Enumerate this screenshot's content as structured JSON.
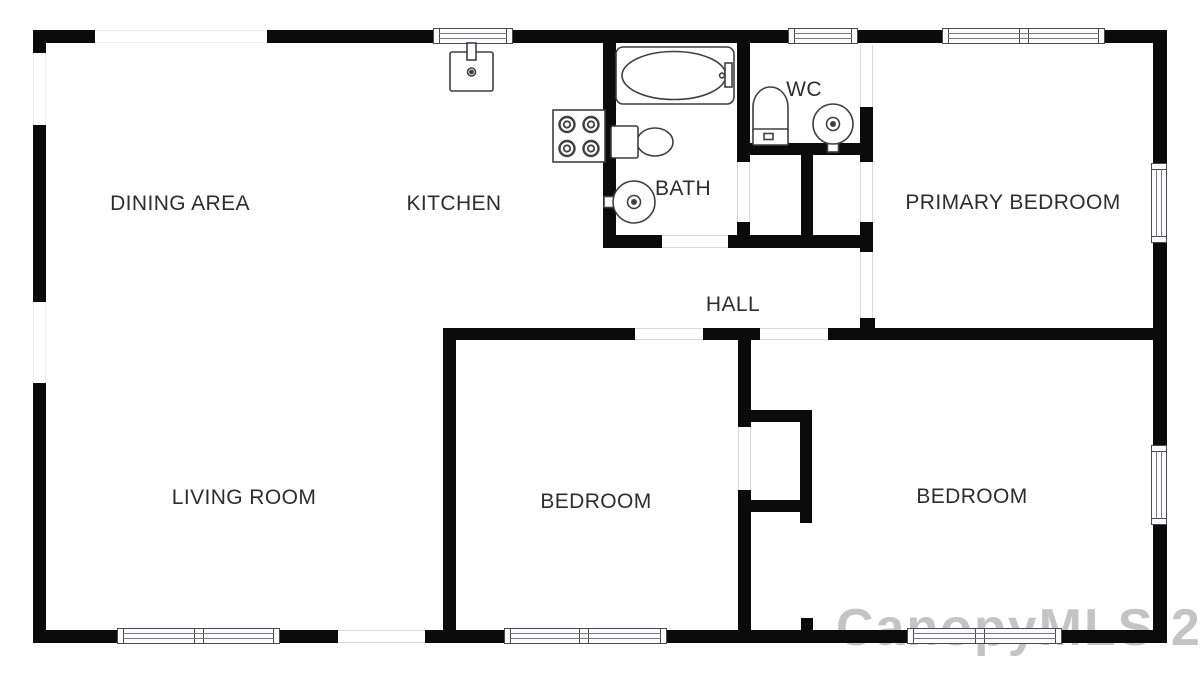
{
  "colors": {
    "wall": "#0b0b0b",
    "window_frame": "#4a4a4a",
    "fixture_stroke": "#3f3f3f",
    "label_text": "#2d2d2d",
    "background": "#ffffff"
  },
  "rooms": [
    {
      "label": "DINING AREA",
      "x": 180,
      "y": 204
    },
    {
      "label": "KITCHEN",
      "x": 454,
      "y": 204
    },
    {
      "label": "BATH",
      "x": 683,
      "y": 189
    },
    {
      "label": "WC",
      "x": 804,
      "y": 90
    },
    {
      "label": "PRIMARY BEDROOM",
      "x": 1013,
      "y": 203
    },
    {
      "label": "HALL",
      "x": 733,
      "y": 305
    },
    {
      "label": "LIVING ROOM",
      "x": 244,
      "y": 498
    },
    {
      "label": "BEDROOM",
      "x": 596,
      "y": 502
    },
    {
      "label": "BEDROOM",
      "x": 972,
      "y": 497
    }
  ],
  "watermark": {
    "text": "CanopyMLS 2023"
  },
  "floorplan": {
    "width": 1200,
    "height": 674,
    "walls": [
      {
        "name": "exterior-wall-top",
        "x": 33,
        "y": 30,
        "w": 1134,
        "h": 13
      },
      {
        "name": "exterior-wall-bottom",
        "x": 33,
        "y": 630,
        "w": 1134,
        "h": 13
      },
      {
        "name": "exterior-wall-left",
        "x": 33,
        "y": 30,
        "w": 13,
        "h": 613
      },
      {
        "name": "exterior-wall-right",
        "x": 1153,
        "y": 30,
        "w": 14,
        "h": 613
      },
      {
        "name": "bath-west-wall",
        "x": 603,
        "y": 43,
        "w": 13,
        "h": 197
      },
      {
        "name": "bath-south-wall",
        "x": 603,
        "y": 235,
        "w": 59,
        "h": 13
      },
      {
        "name": "closet-south-wall",
        "x": 728,
        "y": 235,
        "w": 145,
        "h": 13
      },
      {
        "name": "bath-wc-divider-wall",
        "x": 737,
        "y": 43,
        "w": 13,
        "h": 119
      },
      {
        "name": "wc-south-wall",
        "x": 737,
        "y": 143,
        "w": 136,
        "h": 12
      },
      {
        "name": "closet-divider-wall",
        "x": 801,
        "y": 155,
        "w": 12,
        "h": 93
      },
      {
        "name": "hall-closet-west-jamb",
        "x": 737,
        "y": 222,
        "w": 13,
        "h": 26
      },
      {
        "name": "primary-west-wall-upper",
        "x": 860,
        "y": 107,
        "w": 13,
        "h": 55
      },
      {
        "name": "primary-west-wall-mid",
        "x": 860,
        "y": 222,
        "w": 13,
        "h": 30
      },
      {
        "name": "primary-west-wall-stub",
        "x": 860,
        "y": 318,
        "w": 15,
        "h": 11
      },
      {
        "name": "hall-south-wall-left",
        "x": 443,
        "y": 328,
        "w": 192,
        "h": 12
      },
      {
        "name": "hall-south-wall-mid",
        "x": 703,
        "y": 328,
        "w": 57,
        "h": 12
      },
      {
        "name": "bedrooms-divider-north-wall",
        "x": 828,
        "y": 328,
        "w": 325,
        "h": 12
      },
      {
        "name": "middle-bedroom-west-wall",
        "x": 443,
        "y": 328,
        "w": 13,
        "h": 315
      },
      {
        "name": "bedroom-divider-wall-upper",
        "x": 738,
        "y": 328,
        "w": 13,
        "h": 99
      },
      {
        "name": "bedroom-divider-wall-lower",
        "x": 738,
        "y": 490,
        "w": 13,
        "h": 153
      },
      {
        "name": "bedroom-closet-north-wall",
        "x": 738,
        "y": 410,
        "w": 74,
        "h": 12
      },
      {
        "name": "bedroom-closet-east-wall",
        "x": 800,
        "y": 410,
        "w": 12,
        "h": 113
      },
      {
        "name": "bedroom-closet-south-wall",
        "x": 738,
        "y": 500,
        "w": 74,
        "h": 12
      },
      {
        "name": "bottom-wall-jamb-stub",
        "x": 801,
        "y": 618,
        "w": 12,
        "h": 13
      }
    ],
    "openings": [
      {
        "name": "dining-window-opening",
        "style": "plain",
        "orient": "h",
        "x": 95,
        "y": 30,
        "w": 172,
        "h": 13,
        "mullions": []
      },
      {
        "name": "kitchen-window",
        "style": "framed",
        "orient": "h",
        "x": 433,
        "y": 28,
        "w": 80,
        "h": 16,
        "mullions": []
      },
      {
        "name": "wc-window",
        "style": "framed",
        "orient": "h",
        "x": 788,
        "y": 28,
        "w": 70,
        "h": 16,
        "mullions": []
      },
      {
        "name": "primary-bedroom-north-window",
        "style": "framed",
        "orient": "h",
        "x": 942,
        "y": 28,
        "w": 163,
        "h": 16,
        "mullions": [
          0.5
        ]
      },
      {
        "name": "dining-side-window-opening",
        "style": "plain",
        "orient": "v",
        "x": 33,
        "y": 53,
        "w": 13,
        "h": 72,
        "mullions": []
      },
      {
        "name": "living-side-window-opening",
        "style": "plain",
        "orient": "v",
        "x": 33,
        "y": 302,
        "w": 13,
        "h": 81,
        "mullions": []
      },
      {
        "name": "primary-bedroom-east-window",
        "style": "framed",
        "orient": "v",
        "x": 1151,
        "y": 163,
        "w": 16,
        "h": 80,
        "mullions": []
      },
      {
        "name": "right-bedroom-east-window",
        "style": "framed",
        "orient": "v",
        "x": 1151,
        "y": 445,
        "w": 16,
        "h": 80,
        "mullions": []
      },
      {
        "name": "living-room-window",
        "style": "framed",
        "orient": "h",
        "x": 117,
        "y": 628,
        "w": 163,
        "h": 16,
        "mullions": [
          0.5
        ]
      },
      {
        "name": "living-room-entry-opening",
        "style": "door",
        "orient": "h",
        "x": 338,
        "y": 630,
        "w": 87,
        "h": 13,
        "mullions": []
      },
      {
        "name": "middle-bedroom-window",
        "style": "framed",
        "orient": "h",
        "x": 504,
        "y": 628,
        "w": 163,
        "h": 16,
        "mullions": [
          0.49
        ]
      },
      {
        "name": "right-bedroom-window",
        "style": "framed",
        "orient": "h",
        "x": 907,
        "y": 628,
        "w": 155,
        "h": 16,
        "mullions": [
          0.47
        ]
      },
      {
        "name": "bath-door-opening",
        "style": "door",
        "orient": "h",
        "x": 662,
        "y": 235,
        "w": 66,
        "h": 13,
        "mullions": []
      },
      {
        "name": "hall-closet-door-opening",
        "style": "door",
        "orient": "v",
        "x": 737,
        "y": 162,
        "w": 13,
        "h": 60,
        "mullions": []
      },
      {
        "name": "primary-closet-door-opening",
        "style": "door",
        "orient": "v",
        "x": 860,
        "y": 162,
        "w": 13,
        "h": 60,
        "mullions": []
      },
      {
        "name": "wc-entry-opening",
        "style": "door",
        "orient": "v",
        "x": 860,
        "y": 45,
        "w": 13,
        "h": 62,
        "mullions": []
      },
      {
        "name": "primary-bedroom-door-opening",
        "style": "door",
        "orient": "v",
        "x": 860,
        "y": 252,
        "w": 13,
        "h": 66,
        "mullions": []
      },
      {
        "name": "middle-bedroom-door-opening",
        "style": "door",
        "orient": "h",
        "x": 635,
        "y": 328,
        "w": 68,
        "h": 12,
        "mullions": []
      },
      {
        "name": "right-bedroom-door-opening",
        "style": "door",
        "orient": "h",
        "x": 760,
        "y": 328,
        "w": 68,
        "h": 12,
        "mullions": []
      },
      {
        "name": "bedroom-closet-door-opening",
        "style": "door",
        "orient": "v",
        "x": 738,
        "y": 427,
        "w": 13,
        "h": 63,
        "mullions": []
      }
    ],
    "fixtures": [
      {
        "name": "kitchen-sink",
        "type": "sink-square",
        "x": 450,
        "y": 52,
        "w": 43,
        "h": 39
      },
      {
        "name": "stove",
        "type": "stove",
        "x": 553,
        "y": 110,
        "w": 52,
        "h": 52
      },
      {
        "name": "bathtub",
        "type": "tub",
        "x": 616,
        "y": 47,
        "w": 118,
        "h": 57
      },
      {
        "name": "bath-toilet",
        "type": "toilet-h",
        "tank": [
          611,
          126,
          27,
          32
        ],
        "bowl": [
          637,
          128,
          36,
          28
        ]
      },
      {
        "name": "bath-sink",
        "type": "sink-round",
        "cx": 634,
        "cy": 202,
        "r": 21,
        "faucet": "left"
      },
      {
        "name": "wc-toilet",
        "type": "toilet-v",
        "x": 753,
        "y": 87,
        "w": 35,
        "h": 58
      },
      {
        "name": "wc-sink",
        "type": "sink-round",
        "cx": 833,
        "cy": 124,
        "r": 20,
        "faucet": "bottom"
      }
    ]
  }
}
